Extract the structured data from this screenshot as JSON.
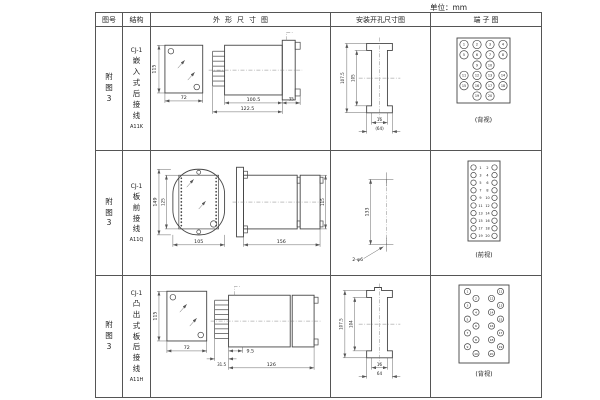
{
  "unit_label": "单位：mm",
  "table": {
    "headers": [
      "图号",
      "结构",
      "外形尺寸图",
      "安装开孔尺寸图",
      "端子图"
    ],
    "rows": [
      {
        "figure": "附图3",
        "structure": {
          "model": "CJ-1",
          "desc": "嵌入式后接线",
          "code": "A11K"
        },
        "outline": {
          "height": "115",
          "width": "72",
          "body_len": "100.5",
          "total_len": "122.5",
          "flange": "35"
        },
        "mounting": {
          "outer": "107.5",
          "inner": "105",
          "slot": "16",
          "span": "(64)"
        },
        "terminal": {
          "style": "grid",
          "view": "(背视)",
          "grid": [
            [
              1,
              2,
              3,
              4
            ],
            [
              5,
              6,
              7,
              8
            ],
            [
              9,
              10
            ],
            [
              11,
              12,
              13,
              14
            ],
            [
              15,
              16,
              17,
              18
            ],
            [
              19,
              20
            ]
          ]
        }
      },
      {
        "figure": "附图3",
        "structure": {
          "model": "CJ-1",
          "desc": "板前接线",
          "code": "A11Q"
        },
        "outline": {
          "height": "149",
          "inner_height": "125",
          "width": "105",
          "length": "156",
          "side_height": "115"
        },
        "mounting": {
          "spacing": "133",
          "holes": "2-φ6"
        },
        "terminal": {
          "style": "pairs",
          "view": "(前视)",
          "numbers": [
            1,
            2,
            3,
            4,
            5,
            6,
            7,
            8,
            9,
            10,
            11,
            12,
            13,
            14,
            15,
            16,
            17,
            18,
            19,
            20
          ]
        }
      },
      {
        "figure": "附图3",
        "structure": {
          "model": "CJ-1",
          "desc": "凸出式板后接线",
          "code": "A11H"
        },
        "outline": {
          "height": "115",
          "width": "72",
          "pins_len": "31.5",
          "offset": "9.5",
          "length": "126"
        },
        "mounting": {
          "outer": "107.5",
          "inner": "104",
          "slot": "16",
          "span": "64"
        },
        "terminal": {
          "style": "zigzag",
          "view": "(背视)",
          "numbers": [
            1,
            2,
            3,
            4,
            5,
            6,
            7,
            8,
            9,
            10,
            11,
            12,
            13,
            14,
            15,
            16,
            17,
            18,
            19,
            20
          ]
        }
      }
    ]
  }
}
